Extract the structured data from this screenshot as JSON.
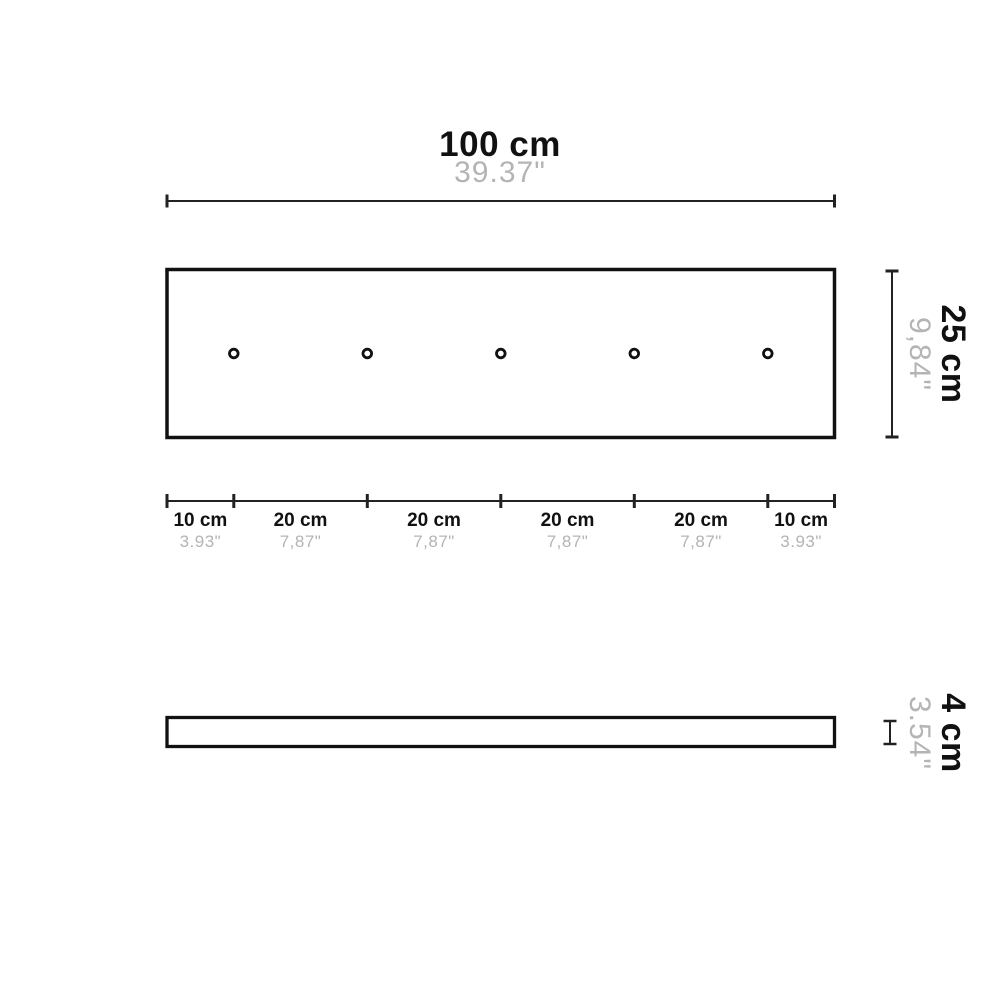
{
  "colors": {
    "line": "#111111",
    "dim_line": "#222222",
    "muted_text": "#b4b4b4"
  },
  "dimension_top": {
    "label": "100 cm",
    "inches": "39.37\""
  },
  "dimension_height": {
    "label": "25 cm",
    "inches": "9,84\""
  },
  "dimension_thickness": {
    "label": "4 cm",
    "inches": "3.54\""
  },
  "dimension_bottom": {
    "segments": [
      {
        "label": "10 cm",
        "inches": "3.93\"",
        "cm": 10
      },
      {
        "label": "20 cm",
        "inches": "7,87\"",
        "cm": 20
      },
      {
        "label": "20 cm",
        "inches": "7,87\"",
        "cm": 20
      },
      {
        "label": "20 cm",
        "inches": "7,87\"",
        "cm": 20
      },
      {
        "label": "20 cm",
        "inches": "7,87\"",
        "cm": 20
      },
      {
        "label": "10 cm",
        "inches": "3.93\"",
        "cm": 10
      }
    ]
  },
  "plate": {
    "width_cm": 100,
    "height_cm": 25,
    "thickness_cm": 4,
    "hole_count": 5,
    "hole_positions_cm": [
      10,
      30,
      50,
      70,
      90
    ]
  }
}
